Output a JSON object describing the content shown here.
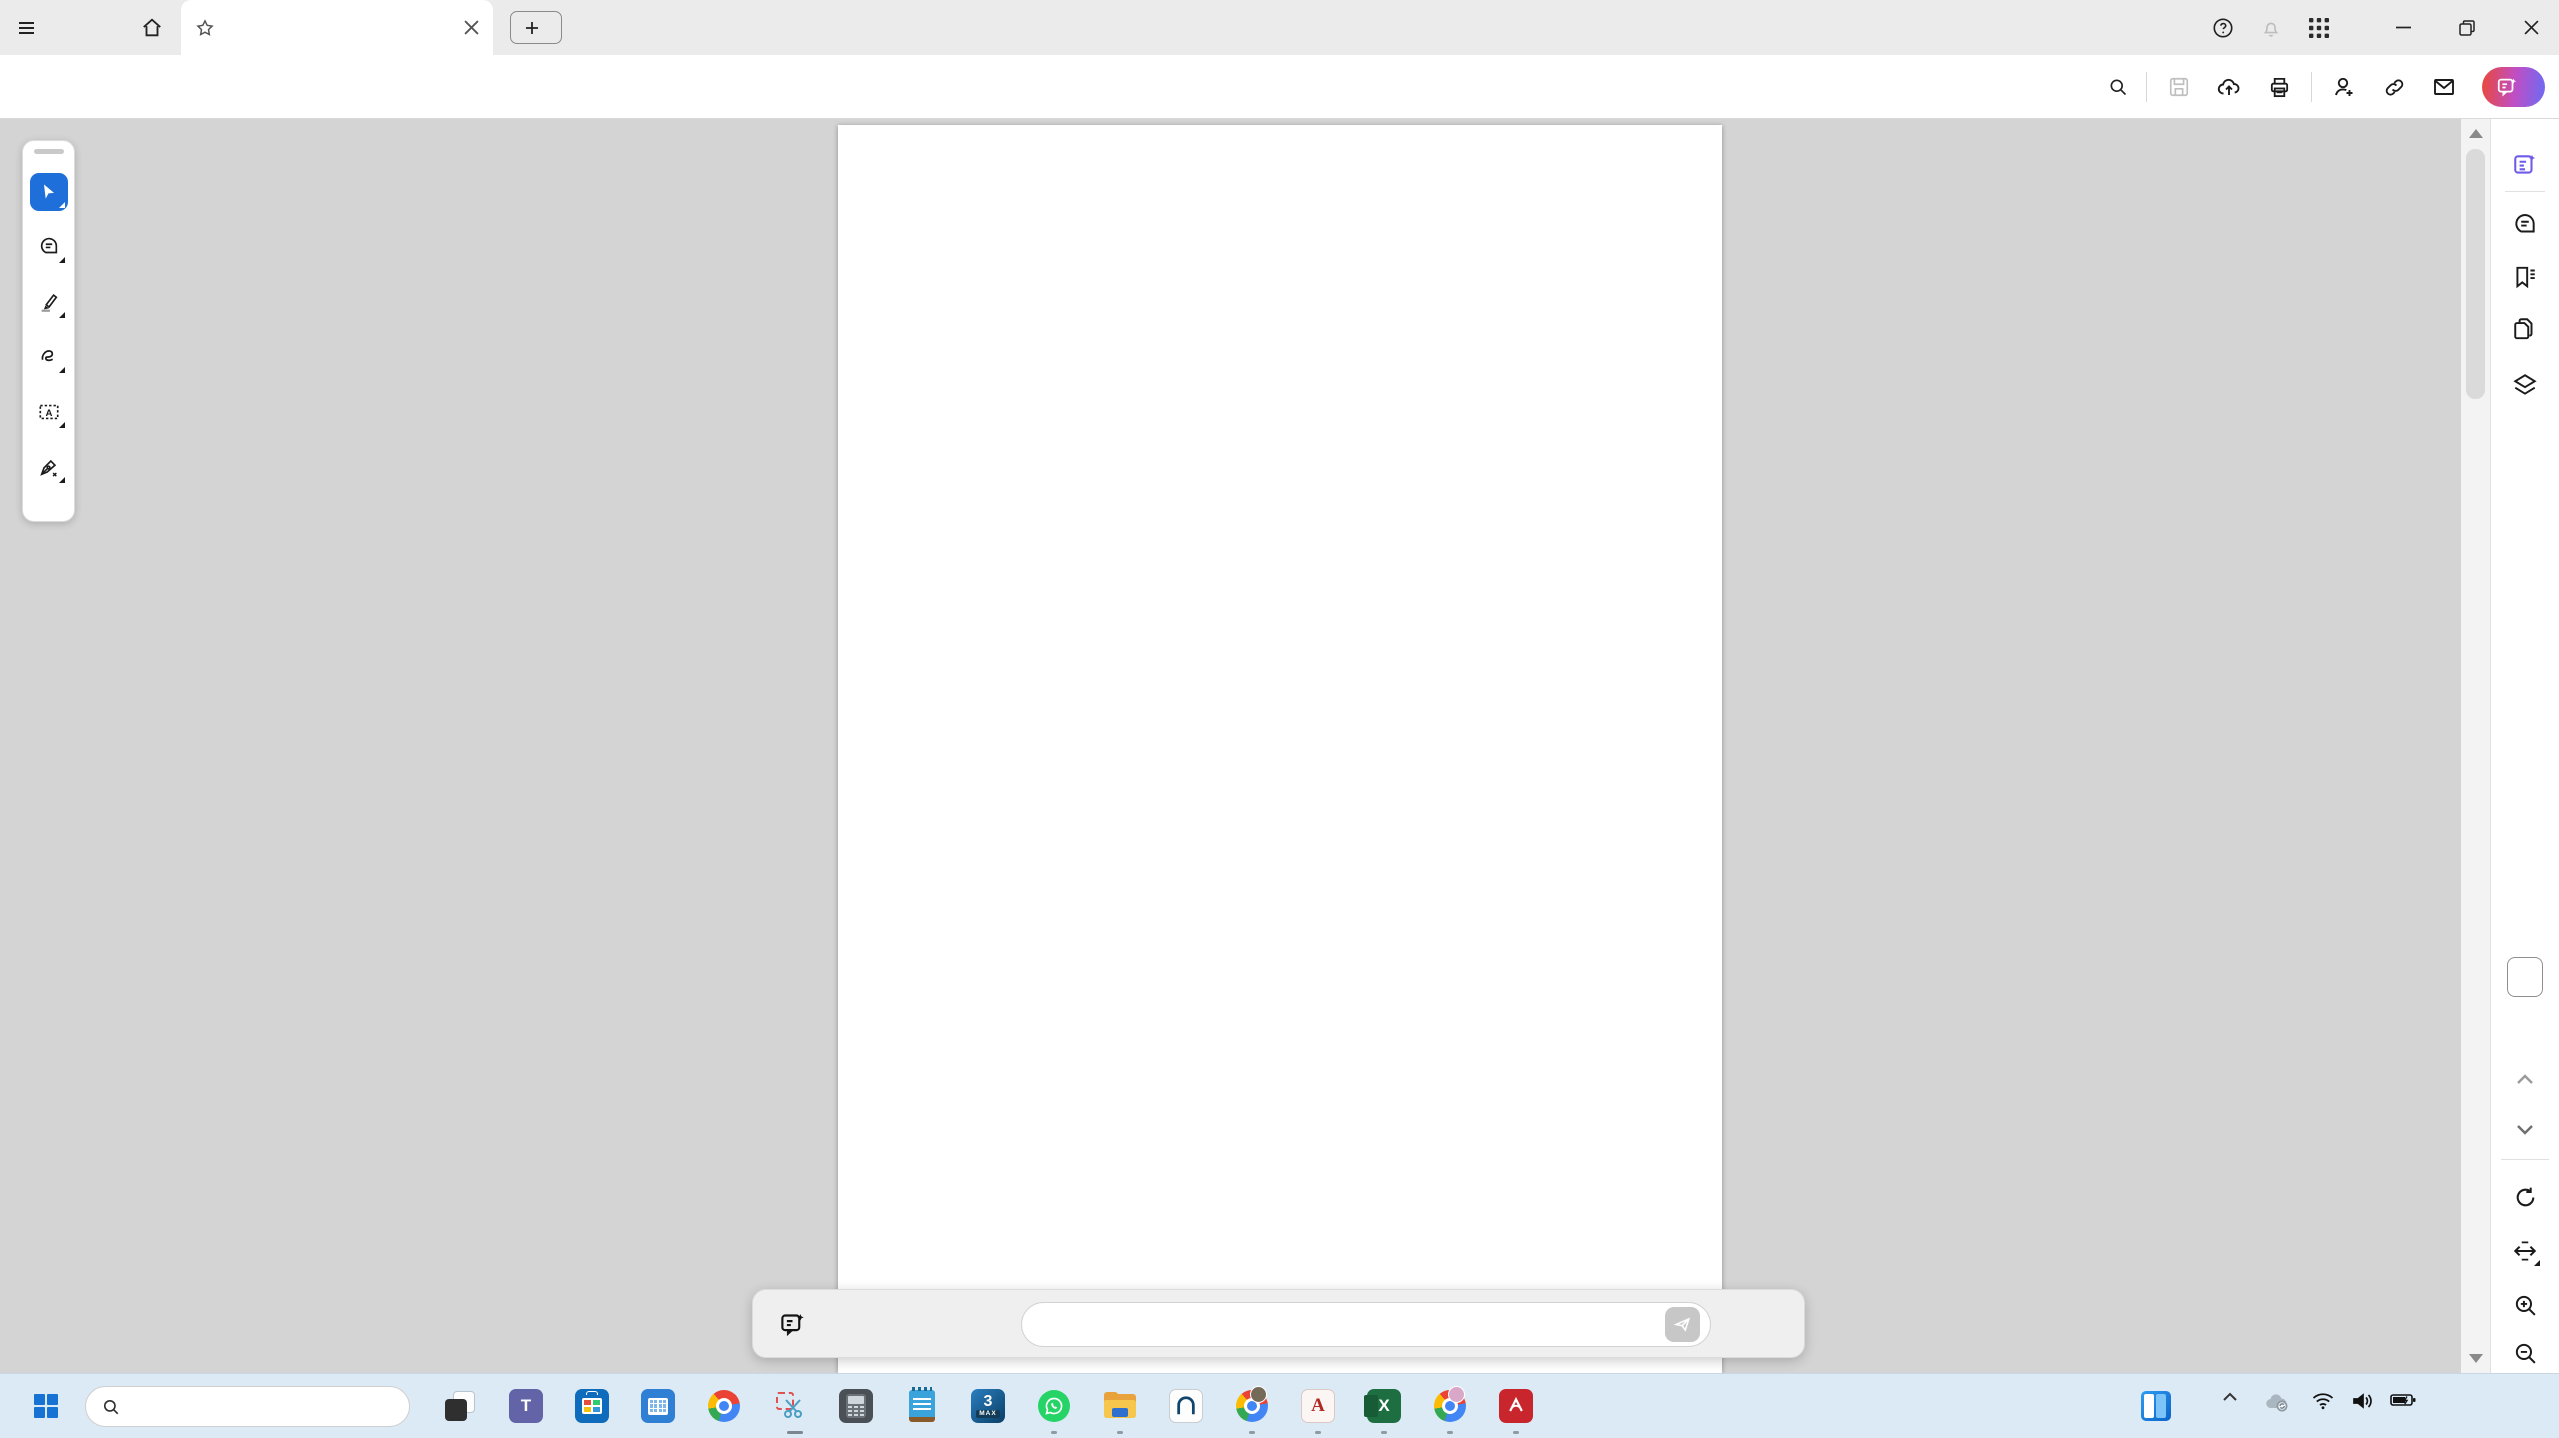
{
  "titlebar": {
    "menu": "Menu",
    "tab_title": "IMM B facade.pdf",
    "create_label": "Create",
    "sign_in": "Sign in"
  },
  "toolbar": {
    "tabs": [
      "All tools",
      "Edit",
      "Convert",
      "E-Sign"
    ],
    "find_label": "Find text or tools",
    "ai_button": "AI Assistant"
  },
  "page_nav": {
    "current_page": "1",
    "total_pages": "1"
  },
  "ai_bar": {
    "label": "Ask AI Assistant",
    "placeholder": "Why is this information important?",
    "more": "•••"
  },
  "drawing": {
    "garage_left_label": "B1",
    "garage_right_label": "B2",
    "level_entrance": "+36,64",
    "level_entrance_top": "+37,49",
    "level_b1": "+36,90",
    "level_b2": "+37,20"
  },
  "taskbar": {
    "search_placeholder": "Rechercher",
    "time": "10:43",
    "date": "05/04/2025"
  }
}
